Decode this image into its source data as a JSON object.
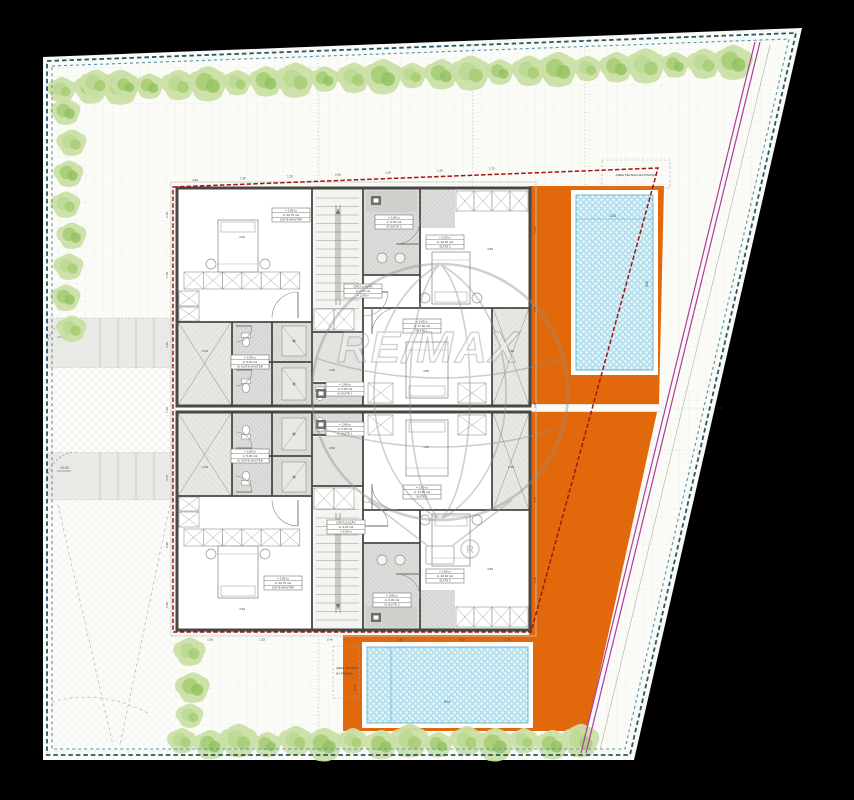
{
  "drawing": {
    "pool_area_label_top": "AREA TECNICA DA PISCINA",
    "pool_area_label_bottom": [
      "ÁREA TÉCNICA",
      "DA PISCINA"
    ],
    "watermark": {
      "brand": "RE/MAX",
      "registered": "R"
    },
    "levels": {
      "drive_upper": "+0.00",
      "drive_lower": "+0.00"
    },
    "rooms": {
      "suite_master": [
        "= 2.80 m",
        "A: 20.70 m2",
        "SUITE MASTER"
      ],
      "is_suite_master": [
        "= 2.80 m",
        "A: 5.00 m2",
        "IS SUITE MASTER"
      ],
      "suite_1": [
        "= 2.80 m",
        "A: 17.00 m2",
        "SUITE 1"
      ],
      "is_suite_1": [
        "= 2.80 m",
        "A: 3.60 m2",
        "IS SUITE 1"
      ],
      "suite_2": [
        "= 2.80 m",
        "A: 20.40 m2",
        "SUITE 2"
      ],
      "is_suite_2": [
        "= 2.80 m",
        "A: 6.00 m2",
        "IS SUITE 2"
      ],
      "circulacao": [
        "CIRCULAÇÃO",
        "A: 6.20 m2",
        "= 2.80 m"
      ]
    },
    "dimensions": {
      "top": [
        "4.90",
        "1.35",
        "1.25",
        "2.40",
        "1.50",
        "1.20",
        "1.75"
      ],
      "bottom": [
        "1.50",
        "1.25",
        "2.40",
        "1.50",
        "4.20",
        "1.75"
      ],
      "left": [
        "1.10",
        "1.70",
        "4.10",
        "1.45",
        "4.75",
        "2.80",
        "1.50"
      ],
      "right": [
        "1.10",
        "4.75",
        "1.50",
        "4.75",
        "1.10"
      ],
      "interior": [
        "4.90",
        "4.85",
        "2.60",
        "1.40",
        "4.50",
        "2.00"
      ],
      "pool_top": [
        "3.00",
        "8.00"
      ],
      "pool_bottom": [
        "8.00",
        "3.00"
      ]
    },
    "colors": {
      "deck_orange": "#e2690b",
      "pool_blue": "#b5e0ee",
      "boundary_blue": "#2e6f8e",
      "setback_red": "#a31515",
      "lot_line_magenta": "#b03aa0",
      "tree_green": "#a8cd74",
      "paper": "#fbfcf8"
    }
  }
}
